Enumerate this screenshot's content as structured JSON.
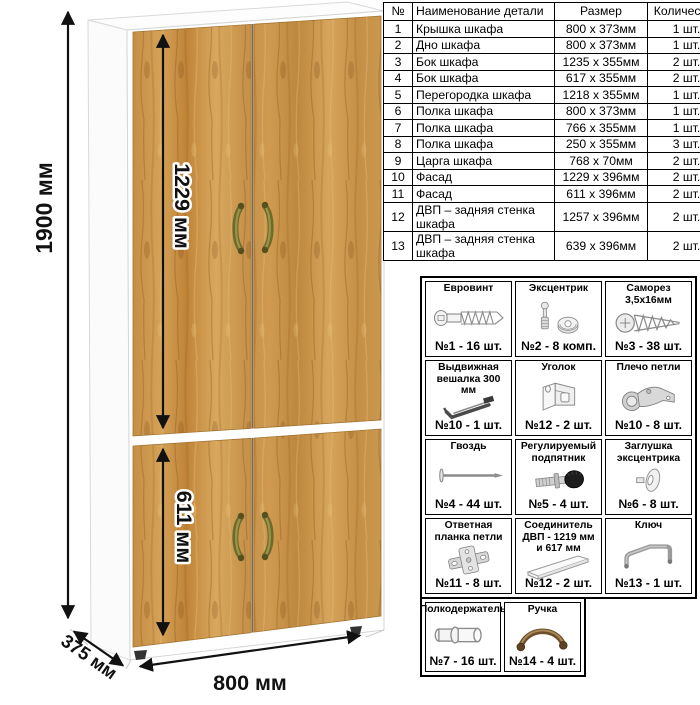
{
  "wardrobe": {
    "dims": {
      "height_label": "1900 мм",
      "upper_door_label": "1229 мм",
      "lower_door_label": "611 мм",
      "width_label": "800 мм",
      "depth_label": "375 мм"
    },
    "colors": {
      "wood_base": "#c8924a",
      "wood_dark": "#a5763a",
      "wood_light": "#ddb06a",
      "handle_bronze": "#7e7a35",
      "cabinet_white": "#ffffff",
      "dimension_line": "#111111"
    }
  },
  "parts_table": {
    "headers": [
      "№",
      "Наименование детали",
      "Размер",
      "Количество"
    ],
    "rows": [
      {
        "num": "1",
        "name": "Крышка шкафа",
        "size": "800 x 373мм",
        "qty": "1 шт."
      },
      {
        "num": "2",
        "name": "Дно шкафа",
        "size": "800 x 373мм",
        "qty": "1 шт."
      },
      {
        "num": "3",
        "name": "Бок шкафа",
        "size": "1235 x 355мм",
        "qty": "2 шт."
      },
      {
        "num": "4",
        "name": "Бок шкафа",
        "size": "617 x 355мм",
        "qty": "2 шт."
      },
      {
        "num": "5",
        "name": "Перегородка шкафа",
        "size": "1218 x 355мм",
        "qty": "1 шт."
      },
      {
        "num": "6",
        "name": "Полка шкафа",
        "size": "800 x 373мм",
        "qty": "1 шт."
      },
      {
        "num": "7",
        "name": "Полка шкафа",
        "size": "766 x 355мм",
        "qty": "1 шт."
      },
      {
        "num": "8",
        "name": "Полка шкафа",
        "size": "250 x 355мм",
        "qty": "3 шт."
      },
      {
        "num": "9",
        "name": "Царга шкафа",
        "size": "768 x 70мм",
        "qty": "2 шт."
      },
      {
        "num": "10",
        "name": "Фасад",
        "size": "1229 x 396мм",
        "qty": "2 шт."
      },
      {
        "num": "11",
        "name": "Фасад",
        "size": "611 x 396мм",
        "qty": "2 шт."
      },
      {
        "num": "12",
        "name": "ДВП – задняя стенка шкафа",
        "size": "1257 x 396мм",
        "qty": "2 шт."
      },
      {
        "num": "13",
        "name": "ДВП – задняя стенка шкафа",
        "size": "639 x 396мм",
        "qty": "2 шт."
      }
    ]
  },
  "hardware": {
    "main_items": [
      {
        "title": "Евровинт",
        "qty": "№1 - 16 шт.",
        "icon": "eurovint"
      },
      {
        "title": "Эксцентрик",
        "qty": "№2 - 8 комп.",
        "icon": "ekstsentrik"
      },
      {
        "title": "Саморез 3,5х16мм",
        "qty": "№3 - 38 шт.",
        "icon": "samorez"
      },
      {
        "title": "Выдвижная вешалка 300 мм",
        "qty": "№10 - 1 шт.",
        "icon": "veshalka"
      },
      {
        "title": "Уголок",
        "qty": "№12 - 2 шт.",
        "icon": "ugolok"
      },
      {
        "title": "Плечо петли",
        "qty": "№10 - 8 шт.",
        "icon": "plecho-petli"
      },
      {
        "title": "Гвоздь",
        "qty": "№4 - 44 шт.",
        "icon": "gvozd"
      },
      {
        "title": "Регулируемый подпятник",
        "qty": "№5 - 4 шт.",
        "icon": "podpyatnik"
      },
      {
        "title": "Заглушка эксцентрика",
        "qty": "№6 - 8 шт.",
        "icon": "zaglushka"
      },
      {
        "title": "Ответная планка петли",
        "qty": "№11 - 8 шт.",
        "icon": "otvetnaya-planka"
      },
      {
        "title": "Соединитель ДВП - 1219 мм и 617 мм",
        "qty": "№12 - 2 шт.",
        "icon": "soedinitel"
      },
      {
        "title": "Ключ",
        "qty": "№13 - 1 шт.",
        "icon": "klyuch"
      }
    ],
    "extra_items": [
      {
        "title": "Полкодержатель",
        "qty": "№7 - 16 шт.",
        "icon": "polkoderzhatel"
      },
      {
        "title": "Ручка",
        "qty": "№14 - 4 шт.",
        "icon": "ruchka"
      }
    ]
  }
}
